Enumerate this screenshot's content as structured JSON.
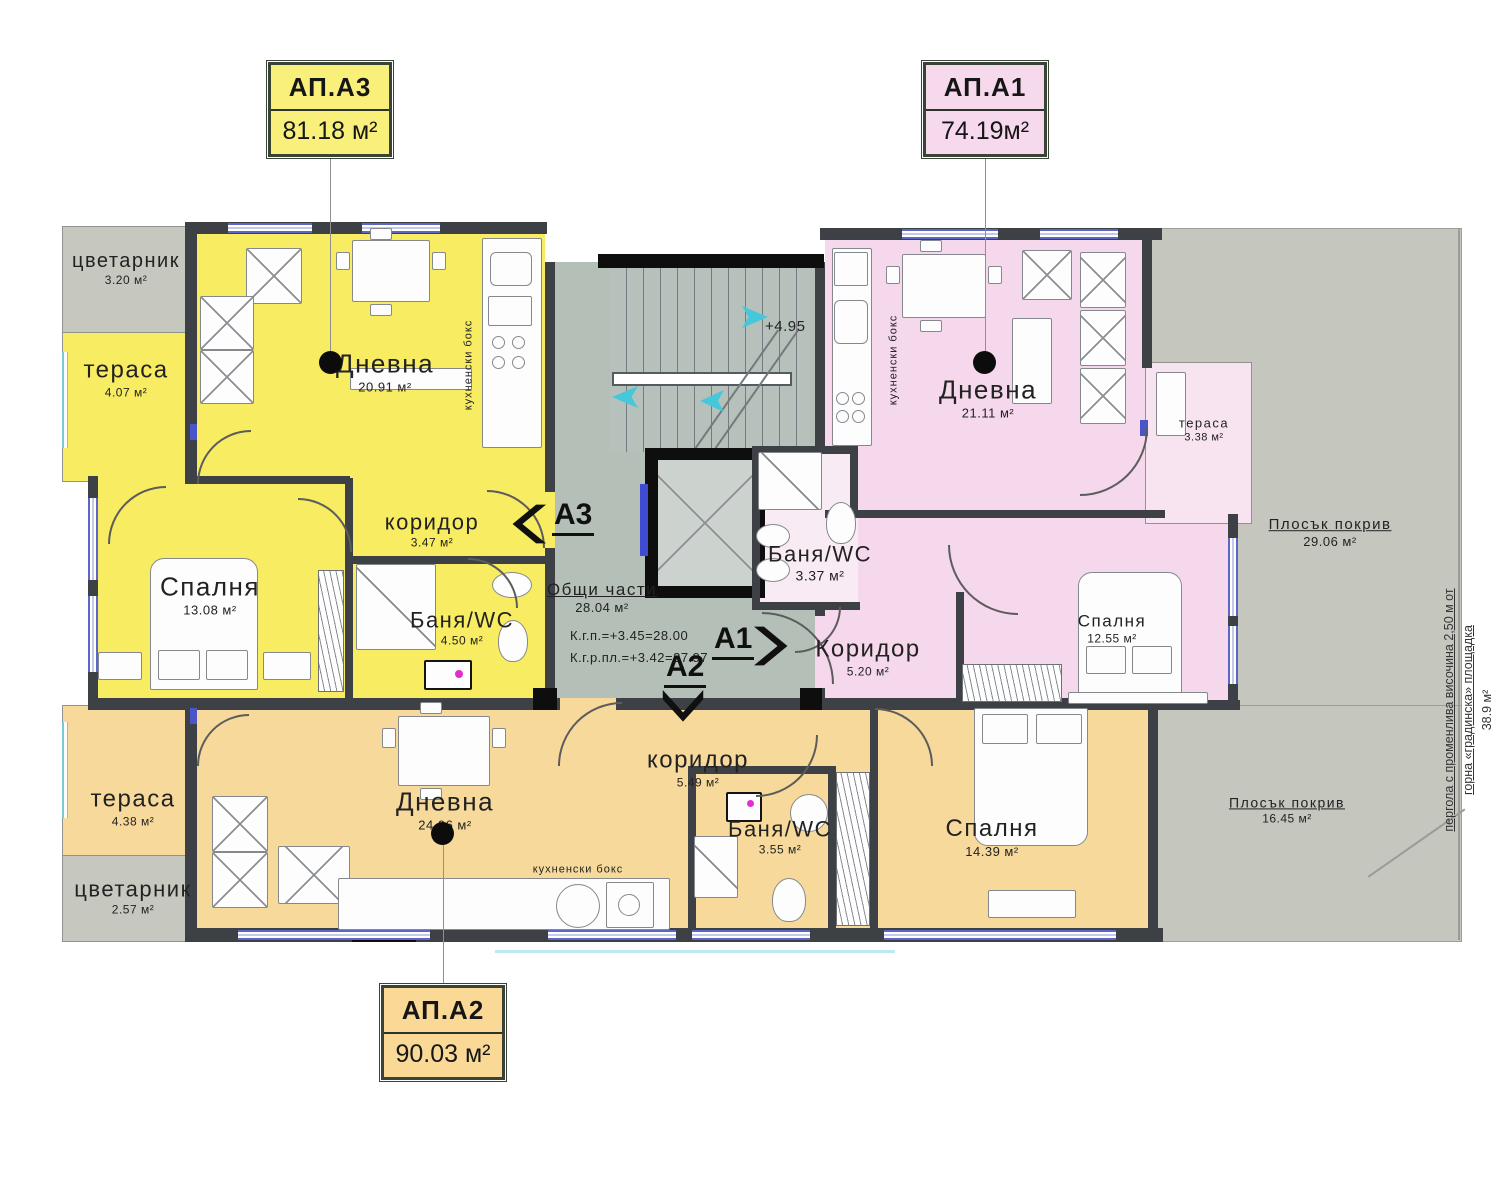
{
  "title_tags": {
    "a3": {
      "label": "АП.А3",
      "area": "81.18 м²"
    },
    "a1": {
      "label": "АП.А1",
      "area": "74.19м²"
    },
    "a2": {
      "label": "АП.А2",
      "area": "90.03 м²"
    }
  },
  "rooms": {
    "a3": {
      "flower": {
        "name": "цветарник",
        "area": "3.20 м²"
      },
      "terrace": {
        "name": "тераса",
        "area": "4.07 м²"
      },
      "living": {
        "name": "Дневна",
        "area": "20.91 м²"
      },
      "kitchen": {
        "name": "кухненски бокс"
      },
      "corridor": {
        "name": "коридор",
        "area": "3.47 м²"
      },
      "bedroom": {
        "name": "Спалня",
        "area": "13.08 м²"
      },
      "bath": {
        "name": "Баня/WC",
        "area": "4.50 м²"
      }
    },
    "a1": {
      "living": {
        "name": "Дневна",
        "area": "21.11 м²"
      },
      "kitchen": {
        "name": "кухненски бокс"
      },
      "bath": {
        "name": "Баня/WC",
        "area": "3.37 м²"
      },
      "corridor": {
        "name": "Коридор",
        "area": "5.20 м²"
      },
      "bedroom": {
        "name": "Спалня",
        "area": "12.55 м²"
      },
      "terrace": {
        "name": "тераса",
        "area": "3.38 м²"
      }
    },
    "a2": {
      "terrace": {
        "name": "тераса",
        "area": "4.38 м²"
      },
      "flower": {
        "name": "цветарник",
        "area": "2.57 м²"
      },
      "living": {
        "name": "Дневна",
        "area": "24.06 м²"
      },
      "kitchen": {
        "name": "кухненски бокс"
      },
      "corridor": {
        "name": "коридор",
        "area": "5.49 м²"
      },
      "bath": {
        "name": "Баня/WC",
        "area": "3.55 м²"
      },
      "bedroom": {
        "name": "Спалня",
        "area": "14.39 м²"
      }
    }
  },
  "common": {
    "title": "Общи части",
    "area": "28.04 м²",
    "level_top": "К.г.п.=+3.45=28.00",
    "level_bottom": "К.г.р.пл.=+3.42=27.97",
    "stair_level": "+4.95"
  },
  "roofs": {
    "top": {
      "name": "Плосък покрив",
      "area": "29.06 м²"
    },
    "bottom": {
      "name": "Плосък покрив",
      "area": "16.45 м²"
    }
  },
  "pergola": {
    "line1": "пергола с променлива височина 2,50 м от",
    "line2": "горна «градинска» площадка",
    "area": "38.9 м²"
  },
  "markers": {
    "a3": "A3",
    "a1": "A1",
    "a2": "A2"
  },
  "colors": {
    "apartment_a3": "#f7ec62",
    "apartment_a1": "#f5d8ec",
    "apartment_a2": "#f7da9b",
    "common_area": "#b4bfb8",
    "flat_roof": "#c5c7bf",
    "window_blue": "#5b66c7",
    "stair_arrow_cyan": "#45c8da"
  }
}
